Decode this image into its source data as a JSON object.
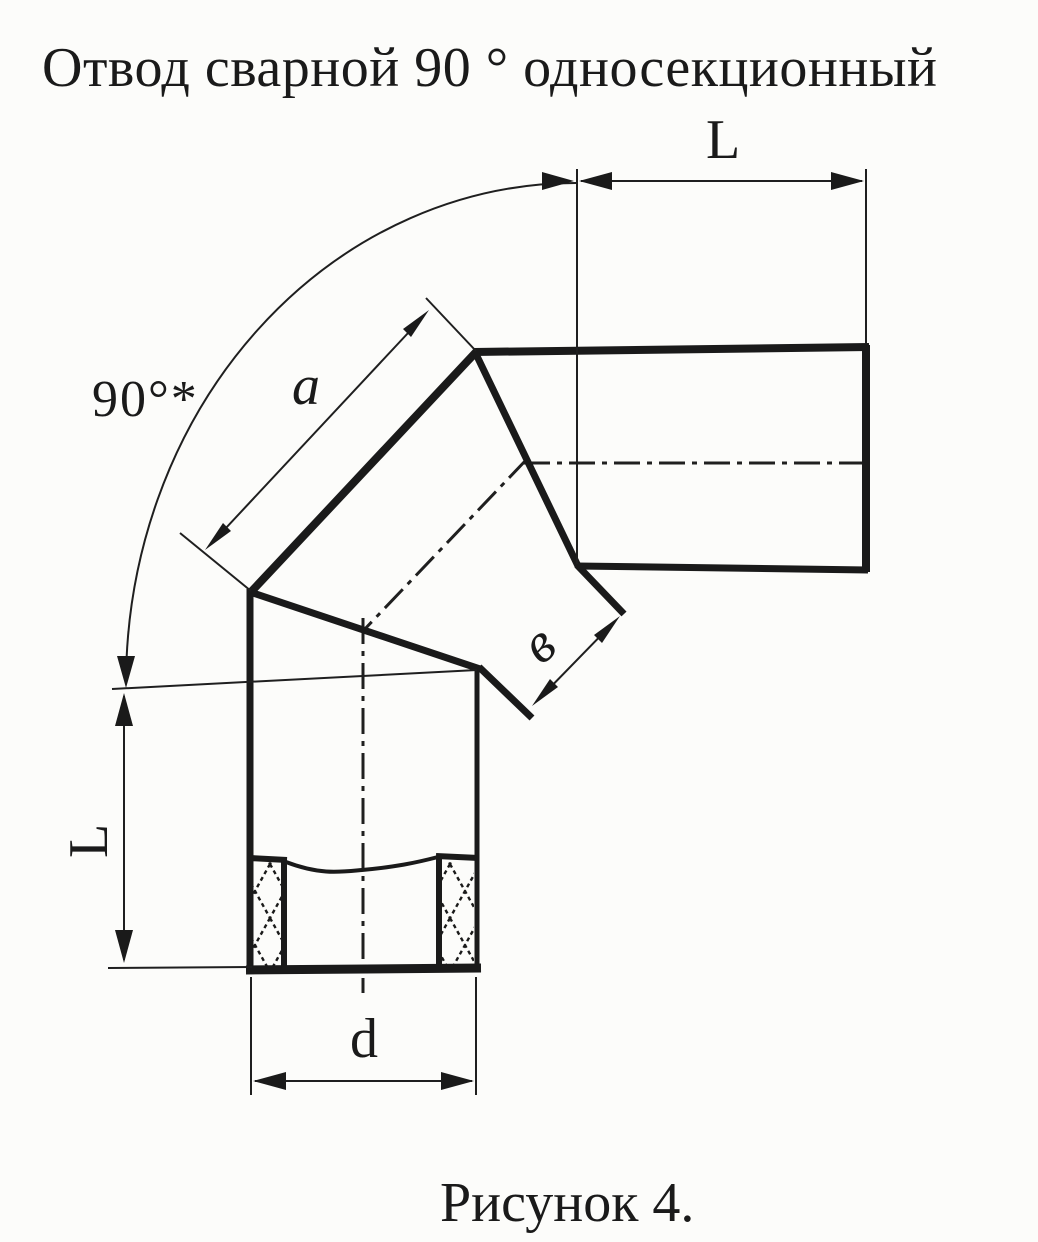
{
  "document": {
    "title": "Отвод сварной 90 ° односекционный",
    "caption": "Рисунок 4."
  },
  "drawing": {
    "labels": {
      "angle": "90°*",
      "segment_outer_side": "a",
      "segment_face_width": "в",
      "branch_length_top": "L",
      "branch_length_left": "L",
      "diameter": "d"
    },
    "colors": {
      "ink": "#1a1a1a",
      "paper": "#fcfcfa"
    }
  }
}
